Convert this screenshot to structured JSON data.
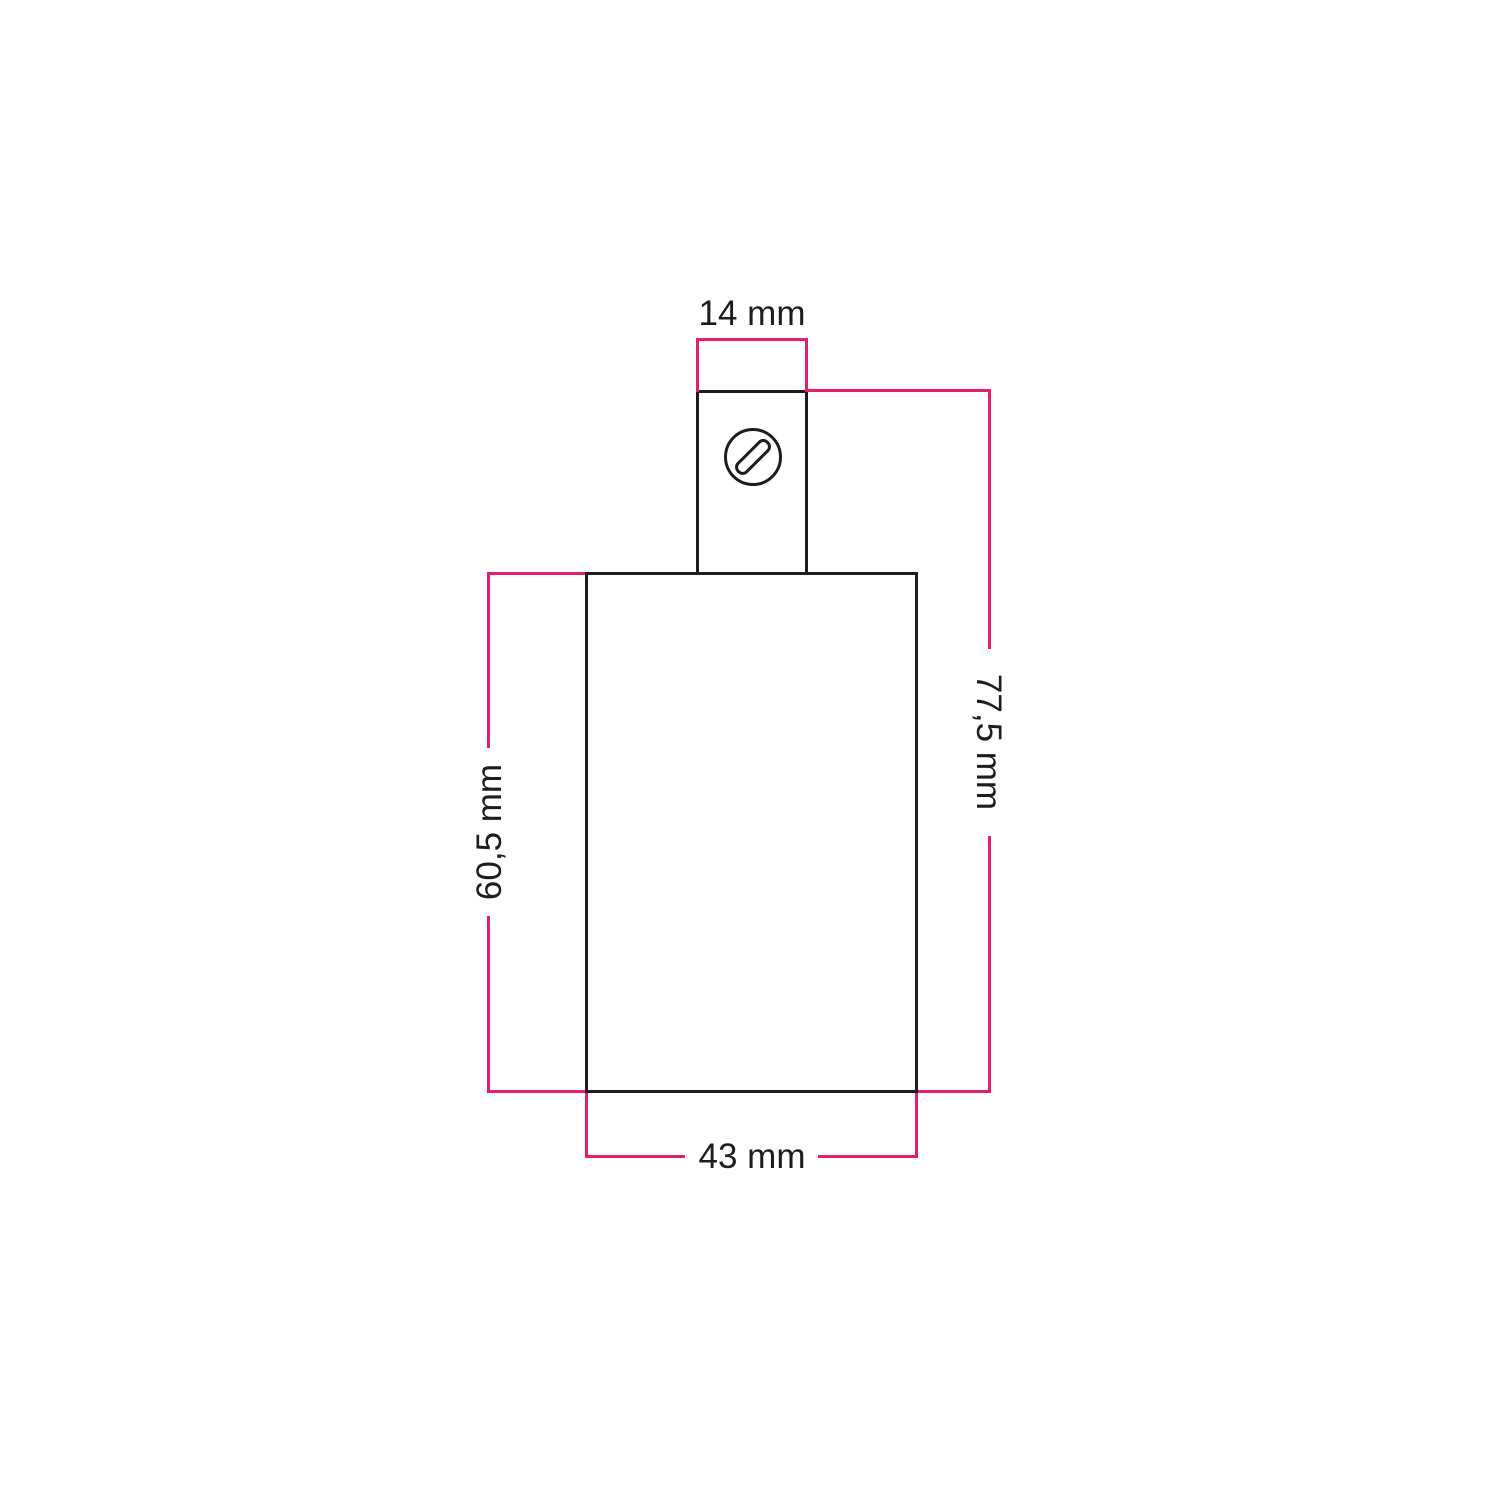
{
  "diagram": {
    "kind": "technical-dimension-drawing",
    "subject": "cylindrical lamp holder with cable gland, front view",
    "unit_labels": {
      "top_width": "14 mm",
      "overall_height": "77,5 mm",
      "body_height": "60,5 mm",
      "body_width": "43 mm"
    },
    "colors": {
      "dimension_line": "#e31e6e",
      "outline": "#1d1d1b",
      "background": "#ffffff"
    },
    "icons": {
      "screw": "slotted-screw-head-icon"
    }
  }
}
